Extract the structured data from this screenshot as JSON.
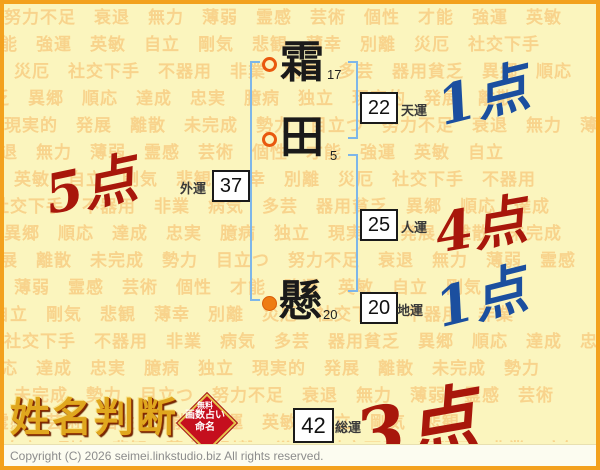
{
  "watermark": {
    "words": [
      "努力不足",
      "衰退",
      "無力",
      "薄弱",
      "霊感",
      "芸術",
      "個性",
      "才能",
      "強運",
      "英敏",
      "自立",
      "剛気",
      "悲観",
      "薄幸",
      "別離",
      "災厄",
      "社交下手",
      "不器用",
      "非業",
      "病気",
      "多芸",
      "器用貧乏",
      "異郷",
      "順応",
      "達成",
      "忠実",
      "臆病",
      "独立",
      "現実的",
      "発展",
      "離散",
      "未完成",
      "勢力",
      "目立つ"
    ]
  },
  "chart": {
    "characters": [
      {
        "char": "霜",
        "strokes": "17",
        "marker": "ring"
      },
      {
        "char": "田",
        "strokes": "5",
        "marker": "ring"
      },
      {
        "char": "懸",
        "strokes": "20",
        "marker": "dot"
      }
    ],
    "tenun": {
      "label": "天運",
      "value": "22",
      "points": "1点",
      "points_color": "blue"
    },
    "gaiun": {
      "label": "外運",
      "value": "37",
      "points": "5点",
      "points_color": "red"
    },
    "jinun": {
      "label": "人運",
      "value": "25",
      "points": "4点",
      "points_color": "red"
    },
    "chiun": {
      "label": "地運",
      "value": "20",
      "points": "1点",
      "points_color": "blue"
    },
    "soun": {
      "label": "総運",
      "value": "42",
      "points": "3点",
      "points_color": "red"
    },
    "colors": {
      "red_point": "#a8170b",
      "blue_point": "#1b4f9f",
      "bracket": "#7db6e9",
      "ring_marker": "#e9590e",
      "dot_marker": "#ee7c12",
      "background": "#fbf5be",
      "border": "#f3a11d"
    }
  },
  "footer": {
    "logo": "姓名判断",
    "stamp": {
      "line1": "無料",
      "line2": "画数占い",
      "line3": "命名"
    },
    "copyright": "Copyright (C) 2026 seimei.linkstudio.biz All rights reserved."
  }
}
